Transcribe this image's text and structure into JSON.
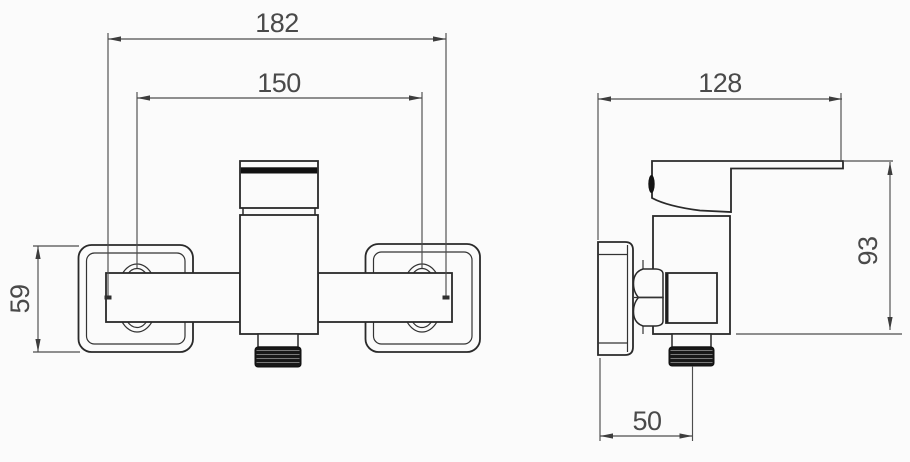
{
  "dims": {
    "front": {
      "overall_width": "182",
      "mounting_centers": "150",
      "escutcheon_height": "59"
    },
    "side": {
      "depth": "128",
      "height": "93",
      "outlet_offset": "50"
    }
  },
  "colors": {
    "line": "#2a2a2a",
    "dimension_line": "#4d4d4d",
    "dimension_text": "#4a4a4a",
    "thread_fill": "#181818",
    "background": "#fbfbfb"
  }
}
